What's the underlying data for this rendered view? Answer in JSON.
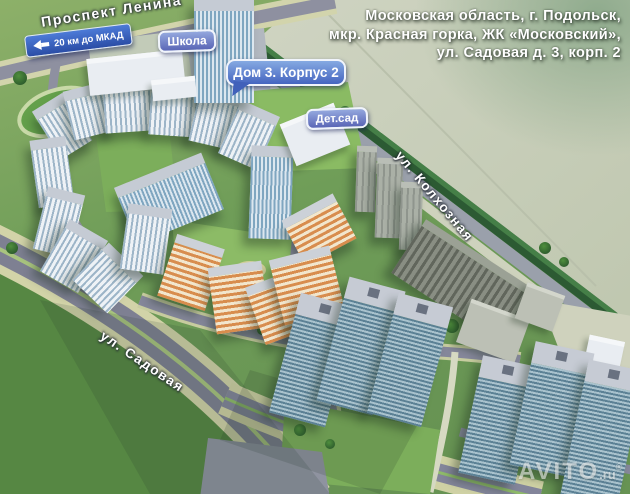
{
  "address": {
    "line1": "Московская область, г. Подольск,",
    "line2": "мкр. Красная горка, ЖК «Московский»,",
    "line3": "ул. Садовая д. 3, корп. 2"
  },
  "labels": {
    "street_lenina": "Проспект Ленина",
    "mkad_sign": "20 км до МКАД",
    "school": "Школа",
    "house_callout": "Дом 3. Корпус 2",
    "kindergarten": "Дет.сад",
    "street_kolkhoznaya": "ул. Колхозная",
    "street_sadovaya": "ул. Садовая"
  },
  "watermark": {
    "brand": "AVITO",
    "suffix": ".ru",
    "reg": "®"
  },
  "colors": {
    "grass": "#6f9d58",
    "grass_dark": "#568743",
    "field": "#c9cfbc",
    "road": "#8e90a0",
    "sidewalk": "#d2d3a8",
    "treeline": "#2c5a33",
    "label_gradient_top": "#94a8de",
    "label_gradient_bottom": "#5a66b6",
    "sign_blue": "#2b4da6",
    "building_roof": "#c5cbd4",
    "building_orange": "#d88d4e"
  }
}
